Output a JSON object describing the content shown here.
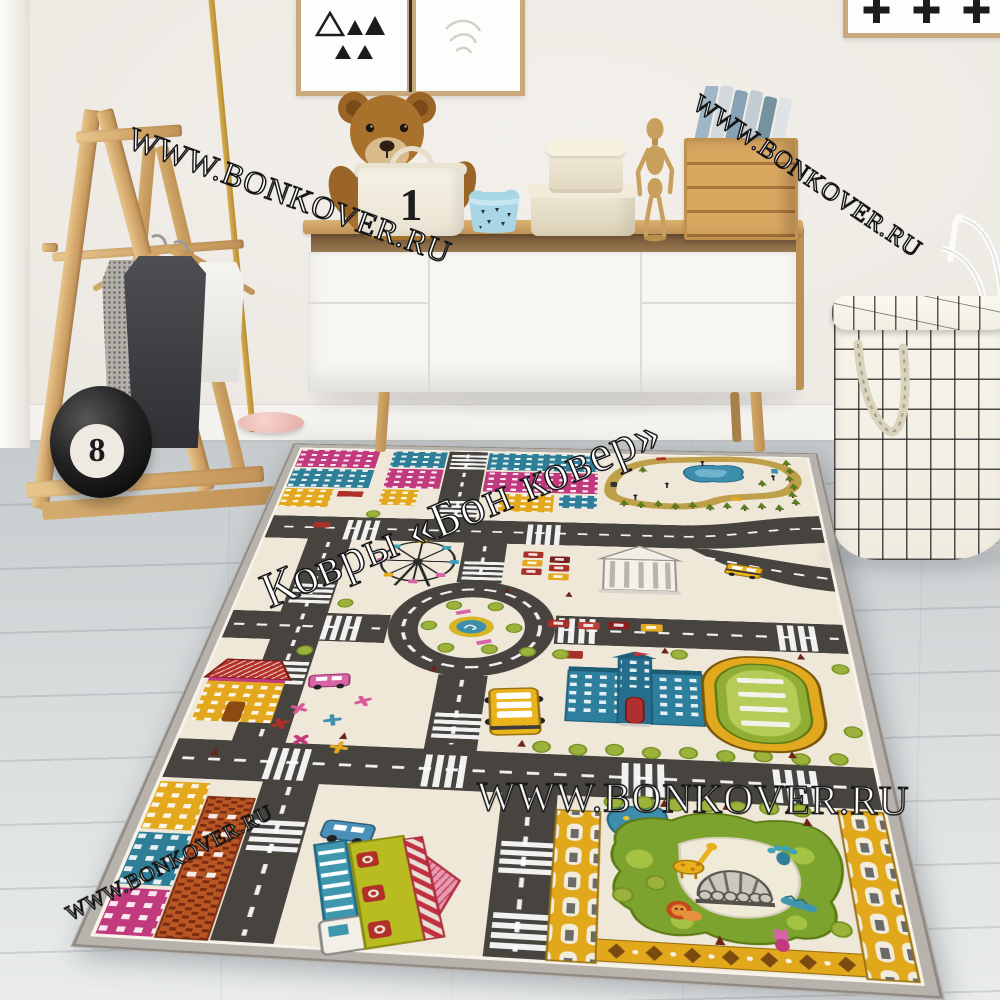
{
  "watermarks": {
    "site_url": "WWW.BONKOVER.RU",
    "brand": "Ковры «Бон ковер»"
  },
  "decor": {
    "eight_ball_label": "8",
    "storage_basket_number": "1"
  },
  "artwork": {
    "left_frame_motif": "black triangles",
    "right_frame_motif": "black plus signs"
  },
  "palette": {
    "wall": "#efece7",
    "floor": "#d4d8d9",
    "wood": "#d2a568",
    "rug_cream": "#efe8d9",
    "rug_border_gray": "#b7b2ac",
    "road_charcoal": "#474440",
    "accent_magenta": "#c23a7e",
    "accent_teal": "#2f7e97",
    "accent_yellow": "#e3a81e",
    "accent_green": "#7ca32e",
    "accent_pink": "#d864a8",
    "accent_red": "#b03028",
    "watermark_fill": "#ffffff",
    "watermark_outline": "#141414"
  }
}
